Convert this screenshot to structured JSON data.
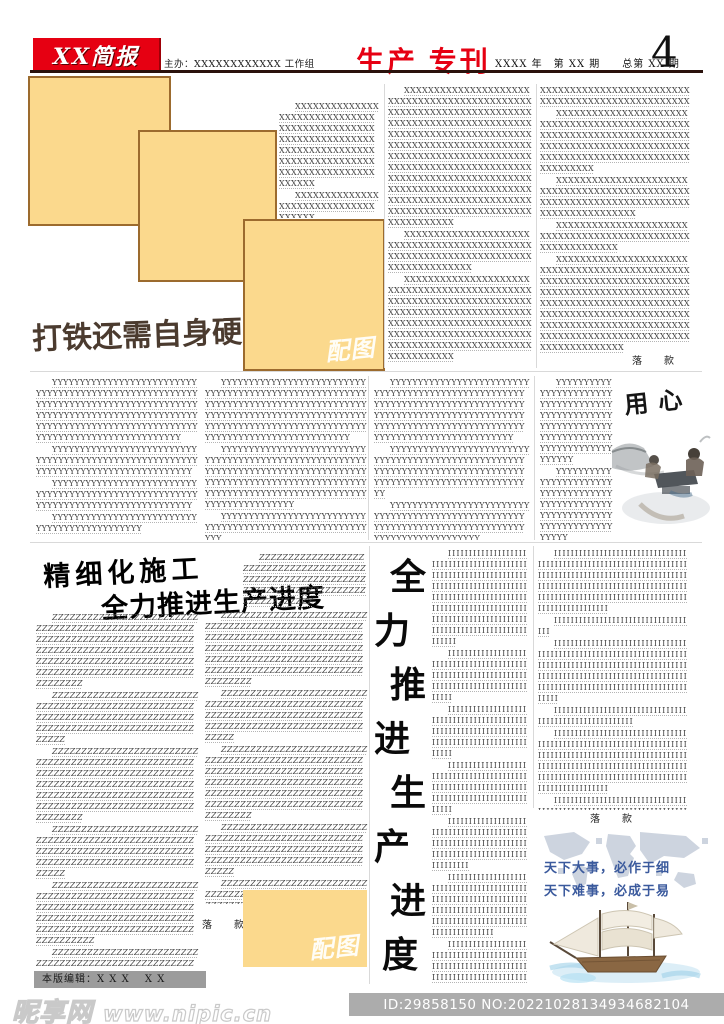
{
  "header": {
    "masthead": "XX简报",
    "organizer": "主办：XXXXXXXXXXXX 工作组",
    "title": "生产 专刊",
    "issue_info": "XXXX 年　第 XX 期　　总第 XX 期",
    "page_number": "4",
    "accent_red": "#e60012",
    "rule_color": "#2a120c"
  },
  "labels": {
    "image_placeholder": "配图",
    "signature": "落　款"
  },
  "colors": {
    "placeholder_fill": "#fbd98d",
    "placeholder_border": "#9c6b2e",
    "quote_blue": "#3b5a9d",
    "text_gray": "#414141"
  },
  "article_top": {
    "headline": "打铁还需自身硬",
    "col_a": [
      "XXXXXXXXXXXXXXXXXXXXXXXXXXXXXXXXXXXXXXXXXXXXXXXXXXXXXXXXXXXXXXXXXXXXXXXXXXXXXXXXXXXXXXXXXXXXXXXXXXXXXXXXXXXXXXXXXXXX",
      "XXXXXXXXXXXXXXXXXXXXXXXXXXXXXXXXXXXX"
    ],
    "col_b": [
      "XXXXXXXXXXXXXXXXXXXXXXXXXXXXXXXXXXXXXXXXXXXXXXXXXXXXXXXXXXXXXXXXXXXXXXXXXXXXXXXXXXXXXXXXXXXXXXXXXXXXXXXXXXXXXXXXXXXXXXXXXXXXXXXXXXXXXXXXXXXXXXXXXXXXXXXXXXXXXXXXXXXXXXXXXXXXXXXXXXXXXXXXXXXXXXXXXXXXXXXXXXXXXXXXXXXXXXXXXXXXXXXXXXXXXXXXXXXXXXXXXXXXXXXXXXXXXXXXXXXXXXXXXXXXXXXXXXXXXXXXXXXXXXXXXXXXXXXX",
      "XXXXXXXXXXXXXXXXXXXXXXXXXXXXXXXXXXXXXXXXXXXXXXXXXXXXXXXXXXXXXXXXXXXXXXXXXXXXXXXXXXX",
      "XXXXXXXXXXXXXXXXXXXXXXXXXXXXXXXXXXXXXXXXXXXXXXXXXXXXXXXXXXXXXXXXXXXXXXXXXXXXXXXXXXXXXXXXXXXXXXXXXXXXXXXXXXXXXXXXXXXXXXXXXXXXXXXXXXXXXXXXXXXXXXXXXXXXXXXXXXXXXXXXXXXXXXXXXXXXXXXX"
    ],
    "col_c": [
      {
        "t": "XXXXXXXXXXXXXXXXXXXXXXXXXXXXXXXXXXXXXXXXXXXXXXXXXX",
        "c": "cont"
      },
      "XXXXXXXXXXXXXXXXXXXXXXXXXXXXXXXXXXXXXXXXXXXXXXXXXXXXXXXXXXXXXXXXXXXXXXXXXXXXXXXXXXXXXXXXXXXXXXXXXXXXXXXXXXXXXXXXXXXXXXXXXXXXXXXXXXX",
      "XXXXXXXXXXXXXXXXXXXXXXXXXXXXXXXXXXXXXXXXXXXXXXXXXXXXXXXXXXXXXXXXXXXXXXXXXXXXXXXXXXXXXXXX",
      "XXXXXXXXXXXXXXXXXXXXXXXXXXXXXXXXXXXXXXXXXXXXXXXXXXXXXXXXXXXX",
      "XXXXXXXXXXXXXXXXXXXXXXXXXXXXXXXXXXXXXXXXXXXXXXXXXXXXXXXXXXXXXXXXXXXXXXXXXXXXXXXXXXXXXXXXXXXXXXXXXXXXXXXXXXXXXXXXXXXXXXXXXXXXXXXXXXXXXXXXXXXXXXXXXXXXXXXXXXXXXXXXXXXXXXXXXXXXXXXXXXXXXXXXXXXXXXXXXXXXXXXXXXXXXXXXXXX"
    ]
  },
  "article_y": {
    "art_title": "用心",
    "col1": [
      "YYYYYYYYYYYYYYYYYYYYYYYYYYYYYYYYYYYYYYYYYYYYYYYYYYYYYYYYYYYYYYYYYYYYYYYYYYYYYYYYYYYYYYYYYYYYYYYYYYYYYYYYYYYYYYYYYYYYYYYYYYYYYYYYYYYYYYYYYYYYYYYYYYYYYYYYYYYYYYYYYYYYYYYY",
      "YYYYYYYYYYYYYYYYYYYYYYYYYYYYYYYYYYYYYYYYYYYYYYYYYYYYYYYYYYYYYYYYYYYYYYYYYYYYYYYYYYY",
      "YYYYYYYYYYYYYYYYYYYYYYYYYYYYYYYYYYYYYYYYYYYYYYYYYYYYYYYYYYYYYYYYYYYYYYYYYYYYYYYYYYY",
      "YYYYYYYYYYYYYYYYYYYYYYYYYYYYYYYYYYYYYYYYYYYYY"
    ],
    "col2": [
      "YYYYYYYYYYYYYYYYYYYYYYYYYYYYYYYYYYYYYYYYYYYYYYYYYYYYYYYYYYYYYYYYYYYYYYYYYYYYYYYYYYYYYYYYYYYYYYYYYYYYYYYYYYYYYYYYYYYYYYYYYYYYYYYYYYYYYYYYYYYYYYYYYYYYYYYYYYYYYYYYYYYYYYYY",
      "YYYYYYYYYYYYYYYYYYYYYYYYYYYYYYYYYYYYYYYYYYYYYYYYYYYYYYYYYYYYYYYYYYYYYYYYYYYYYYYYYYYYYYYYYYYYYYYYYYYYYYYYYYYYYYYYYYYYYYYYYYYYYYYYYYYYYYYYYYYYYYYYYYYYYYYYYYYYYY",
      "YYYYYYYYYYYYYYYYYYYYYYYYYYYYYYYYYYYYYYYYYYYYYYYYYYYYYYYYYY"
    ],
    "col3": [
      "YYYYYYYYYYYYYYYYYYYYYYYYYYYYYYYYYYYYYYYYYYYYYYYYYYYYYYYYYYYYYYYYYYYYYYYYYYYYYYYYYYYYYYYYYYYYYYYYYYYYYYYYYYYYYYYYYYYYYYYYYYYYYYYYYYYYYYYYYYYYYYYYYYYYYYYYYYYYYY",
      "YYYYYYYYYYYYYYYYYYYYYYYYYYYYYYYYYYYYYYYYYYYYYYYYYYYYYYYYYYYYYYYYYYYYYYYYYYYYYYYYYYYYYYYYYYYYYYYYYYYYYYYYYYYY",
      "YYYYYYYYYYYYYYYYYYYYYYYYYYYYYYYYYYYYYYYYYYYYYYYYYYYYYYYYYYYYYYYYYYYYYYYYYYYYYYYYYYYYYYYYYYYYYYYYYY"
    ],
    "col4": [
      "YYYYYYYYYYYYYYYYYYYYYYYYYYYYYYYYYYYYYYYYYYYYYYYYYYYYYYYYYYYYYYYYYYYYYYYYYYYYYYYYYYYYYYYYYYYYYY",
      "YYYYYYYYYYYYYYYYYYYYYYYYYYYYYYYYYYYYYYYYYYYYYYYYYYYYYYYYYYYYYYYYYYYYYYYYYYYYYYYY"
    ]
  },
  "article_z": {
    "headline_line1": "精细化施工",
    "headline_line2": "全力推进生产进度",
    "vertical_headline": [
      "全",
      "力",
      "推",
      "进",
      "生",
      "产",
      "进",
      "度"
    ],
    "col2_top": [
      "ZZZZZZZZZZZZZZZZZZZZZZZZZZZZZZZZZZZZZZZZZZZZZZZZZZZZZZZZZZZZZZZZZZZZZZZZZZZZZZZZZZZZZZZZZZZZZ"
    ],
    "col1": [
      "ZZZZZZZZZZZZZZZZZZZZZZZZZZZZZZZZZZZZZZZZZZZZZZZZZZZZZZZZZZZZZZZZZZZZZZZZZZZZZZZZZZZZZZZZZZZZZZZZZZZZZZZZZZZZZZZZZZZZZZZZZZZZZZZZZZZZZZZZZZZZZZZZZZZZZZZZZZZZZZZZZZZZZZZZ",
      "ZZZZZZZZZZZZZZZZZZZZZZZZZZZZZZZZZZZZZZZZZZZZZZZZZZZZZZZZZZZZZZZZZZZZZZZZZZZZZZZZZZZZZZZZZZZZZZZZZZZZZZZZZZZZZZZ",
      "ZZZZZZZZZZZZZZZZZZZZZZZZZZZZZZZZZZZZZZZZZZZZZZZZZZZZZZZZZZZZZZZZZZZZZZZZZZZZZZZZZZZZZZZZZZZZZZZZZZZZZZZZZZZZZZZZZZZZZZZZZZZZZZZZZZZZZZZZZZZZZZZZZZZZZZZZZZZZZZZZZZZZZZZZ",
      "ZZZZZZZZZZZZZZZZZZZZZZZZZZZZZZZZZZZZZZZZZZZZZZZZZZZZZZZZZZZZZZZZZZZZZZZZZZZZZZZZZZZZZZZZZZZZZZZZZZZZZZZZZZZZZZZ",
      "ZZZZZZZZZZZZZZZZZZZZZZZZZZZZZZZZZZZZZZZZZZZZZZZZZZZZZZZZZZZZZZZZZZZZZZZZZZZZZZZZZZZZZZZZZZZZZZZZZZZZZZZZZZZZZZZZZZZZZZZZZZZZZZZZZZZZZZZZZZZZZZZ",
      "ZZZZZZZZZZZZZZZZZZZZZZZZZZZZZZZZZZZZZZZZZZZZZZZZZZZZZZZZZZZZZZZZZZZZZZZZZZZZZZZZZZZZZZZZZZZZZ",
      "ZZZZZZZZZZZZZZZZZZZZZZZZZZZZZZZZZZZZZZZZZZZZZZZZZZZZZZZ"
    ],
    "col2": [
      "ZZZZZZZZZZZZZZZZZZZZZZZZZZZZZZZZZZZZZZZZZZZZZZZZZZZZZZZZZZZZZZZZZZZZZZZZZZZZZZZZZZZZZZZZZZZZZZZZZZZZZZZZZZZZZZZZZZZZZZZZZZZZZZZZZZZZZZZZZZZZZZZZZZZZZZZZZZZZZZZZZZZZZZZZ",
      "ZZZZZZZZZZZZZZZZZZZZZZZZZZZZZZZZZZZZZZZZZZZZZZZZZZZZZZZZZZZZZZZZZZZZZZZZZZZZZZZZZZZZZZZZZZZZZZZZZZZZZZZZZZZZZZZ",
      "ZZZZZZZZZZZZZZZZZZZZZZZZZZZZZZZZZZZZZZZZZZZZZZZZZZZZZZZZZZZZZZZZZZZZZZZZZZZZZZZZZZZZZZZZZZZZZZZZZZZZZZZZZZZZZZZZZZZZZZZZZZZZZZZZZZZZZZZZZZZZZZZZZZZZZZZZZZZZZZZZZZZZZZZZ",
      "ZZZZZZZZZZZZZZZZZZZZZZZZZZZZZZZZZZZZZZZZZZZZZZZZZZZZZZZZZZZZZZZZZZZZZZZZZZZZZZZZZZZZZZZZZZZZZZZZZZZZZZZZZZZZZZZ",
      "ZZZZZZZZZZZZZZZZZZZZZZZZZZZZZZZZZZZZZZZZZZZZZZZZZZZZZZZZZZZZZZZZZZZZZZZZZZZZZZZZZZZZZZZZZZZZZZZZZZZZZZZZZZZZ"
    ],
    "col_i3": [
      "IIIIIIIIIIIIIIIIIIIIIIIIIIIIIIIIIIIIIIIIIIIIIIIIIIIIIIIIIIIIIIIIIIIIIIIIIIIIIIIIIIIIIIIIIIIIIIIIIIIIIIIIIIIIIIIIIIIIIIIIIIIIIIIIIIIIIIIIIIIIIIIIIIIIIIIIIIIIIIIIIIIIIIIIIIIIIIIIIIIIIIIIII",
      "IIIIIIIIIIIIIIIIIIIIIIIIIIIIIIIIIIIIIIIIIIIIIIIIIIIIIIIIIIIIIIIIIIIIIIIIIIIIIIIIIIIIIIIIIIIII",
      "IIIIIIIIIIIIIIIIIIIIIIIIIIIIIIIIIIIIIIIIIIIIIIIIIIIIIIIIIIIIIIIIIIIIIIIIIIIIIIIIIIIIIIIIIIIII",
      "IIIIIIIIIIIIIIIIIIIIIIIIIIIIIIIIIIIIIIIIIIIIIIIIIIIIIIIIIIIIIIIIIIIIIIIIIIIIIIIIIIIIIIIIIIIII",
      "IIIIIIIIIIIIIIIIIIIIIIIIIIIIIIIIIIIIIIIIIIIIIIIIIIIIIIIIIIIIIIIIIIIIIIIIIIIIIIIIIIIIIIIIIIIIIIIII",
      "IIIIIIIIIIIIIIIIIIIIIIIIIIIIIIIIIIIIIIIIIIIIIIIIIIIIIIIIIIIIIIIIIIIIIIIIIIIIIIIIIIIIIIIIIIIIIIIIIIIIIIIIIIIIIIIIIIIIIIIIIIIIII",
      "IIIIIIIIIIIIIIIIIIIIIIIIIIIIIIIIIIIIIIIIIIIIIIIIIIIIIIIIIIIIIIIIIIIIIIIIIIIIIIIIIIIIIIIIIIIIIIIIIIIIIIIIIIIIIIIIIIIIIIIIIIIIIIIIIIIIIIIIIIIIIIIIIIIIIIIIIIII"
    ],
    "col_i4": [
      "IIIIIIIIIIIIIIIIIIIIIIIIIIIIIIIIIIIIIIIIIIIIIIIIIIIIIIIIIIIIIIIIIIIIIIIIIIIIIIIIIIIIIIIIIIIIIIIIIIIIIIIIIIIIIIIIIIIIIIIIIIIIIIIIIIIIIIIIIIIIIIIIIIIIIIIIIIIIIIIIIIIIIIIIIIIIIIIIIIIIIIIIIIIIIIIII",
      "IIIIIIIIIIIIIIIIIIIIIIIIIIIIIIIIIII",
      "IIIIIIIIIIIIIIIIIIIIIIIIIIIIIIIIIIIIIIIIIIIIIIIIIIIIIIIIIIIIIIIIIIIIIIIIIIIIIIIIIIIIIIIIIIIIIIIIIIIIIIIIIIIIIIIIIIIIIIIIIIIIIIIIIIIIIIIIIIIIIIIIIIIIIIIIIIIIIIIIIIIIIIIIIIIIIIIIIIIII",
      "IIIIIIIIIIIIIIIIIIIIIIIIIIIIIIIIIIIIIIIIIIIIIIIIIIIIIII",
      "IIIIIIIIIIIIIIIIIIIIIIIIIIIIIIIIIIIIIIIIIIIIIIIIIIIIIIIIIIIIIIIIIIIIIIIIIIIIIIIIIIIIIIIIIIIIIIIIIIIIIIIIIIIIIIIIIIIIIIIIIIIIIIIIIIIIIIIIIIIIIIIIIIIIIIIIIIIIIIIIIIIIIIIIIIIIIIIIIIIIIIIIIIIIIIIII",
      "IIIIIIIIIIIIIIIIIIIIIIIIIIIIIIIIIIIIIIIIIIIIIIIIIIIIIIIIIIIIIIIIIIIIIIIIIIIIIIIIIIIIIIIIIIIIIIIIIIIIIIIIIIIIIIIIIIII"
    ],
    "quote_line1": "天下大事，必作于细",
    "quote_line2": "天下难事，必成于易"
  },
  "footer": {
    "editor": "本版编辑：X X X　 X X"
  },
  "watermark": {
    "site_name": "昵享网",
    "site_url": "www.nipic.cn",
    "id_text": "ID:29858150 NO:20221028134934682104"
  }
}
